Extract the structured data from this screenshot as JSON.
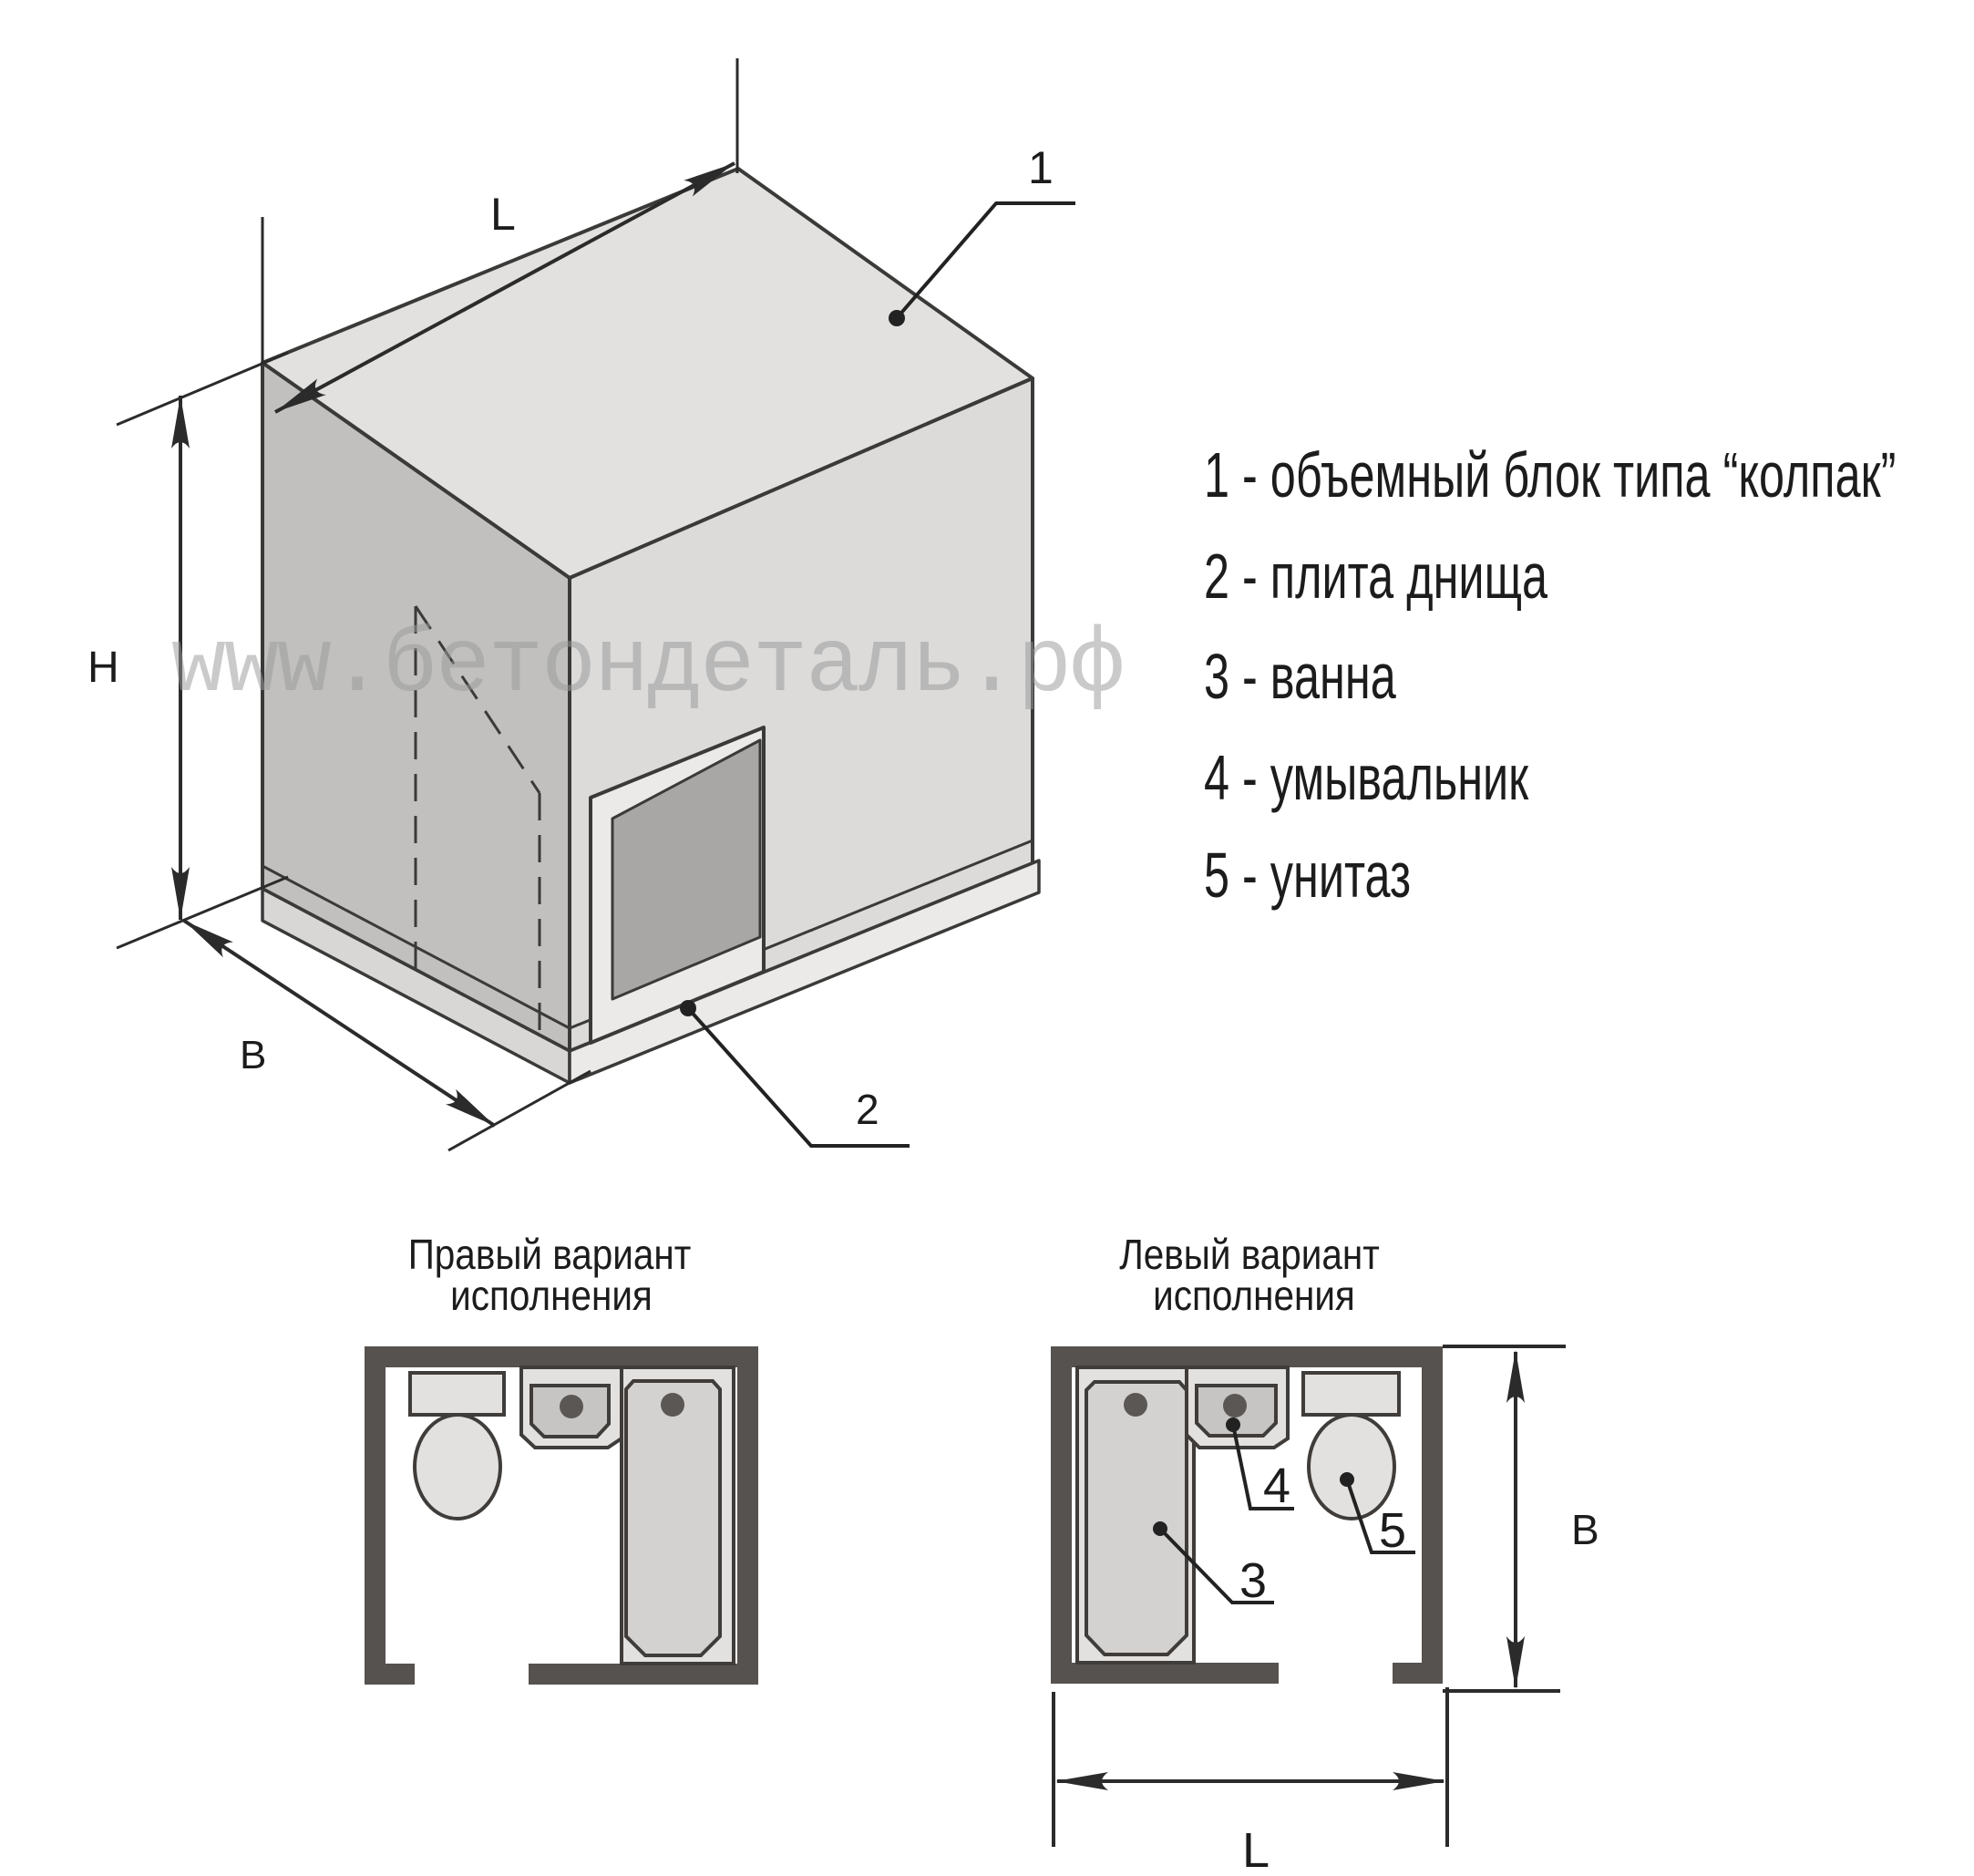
{
  "watermark_text": "www.бетондеталь.рф",
  "legend": {
    "items": [
      "1 - объемный блок типа “колпак”",
      "2 - плита днища",
      "3 - ванна",
      "4 - умывальник",
      "5 - унитаз"
    ]
  },
  "isometric": {
    "dim_length": "L",
    "dim_height": "H",
    "dim_width": "B",
    "callout_block": "1",
    "callout_slab": "2"
  },
  "plans": {
    "right_variant": {
      "title1": "Правый вариант",
      "title2": "исполнения"
    },
    "left_variant": {
      "title1": "Левый вариант",
      "title2": "исполнения",
      "callout_bath": "3",
      "callout_sink": "4",
      "callout_toilet": "5",
      "dim_width": "В",
      "dim_length": "L"
    }
  },
  "colors": {
    "line": "#3a3a38",
    "text": "#1c1c1c",
    "wall": "#56524f",
    "face_top": "#e2e1df",
    "face_left": "#c1c0be",
    "face_right": "#dcdbd9",
    "door_opening": "#a9a7a5",
    "door_frame": "#eceae8",
    "slab_left": "#d8d7d5",
    "slab_right": "#ebeae8",
    "fixture": "#e3e1df",
    "basin": "#c7c5c3",
    "tub_inner": "#d4d2d0",
    "dot": "#5a5755",
    "watermark": "#9a9a9a"
  }
}
